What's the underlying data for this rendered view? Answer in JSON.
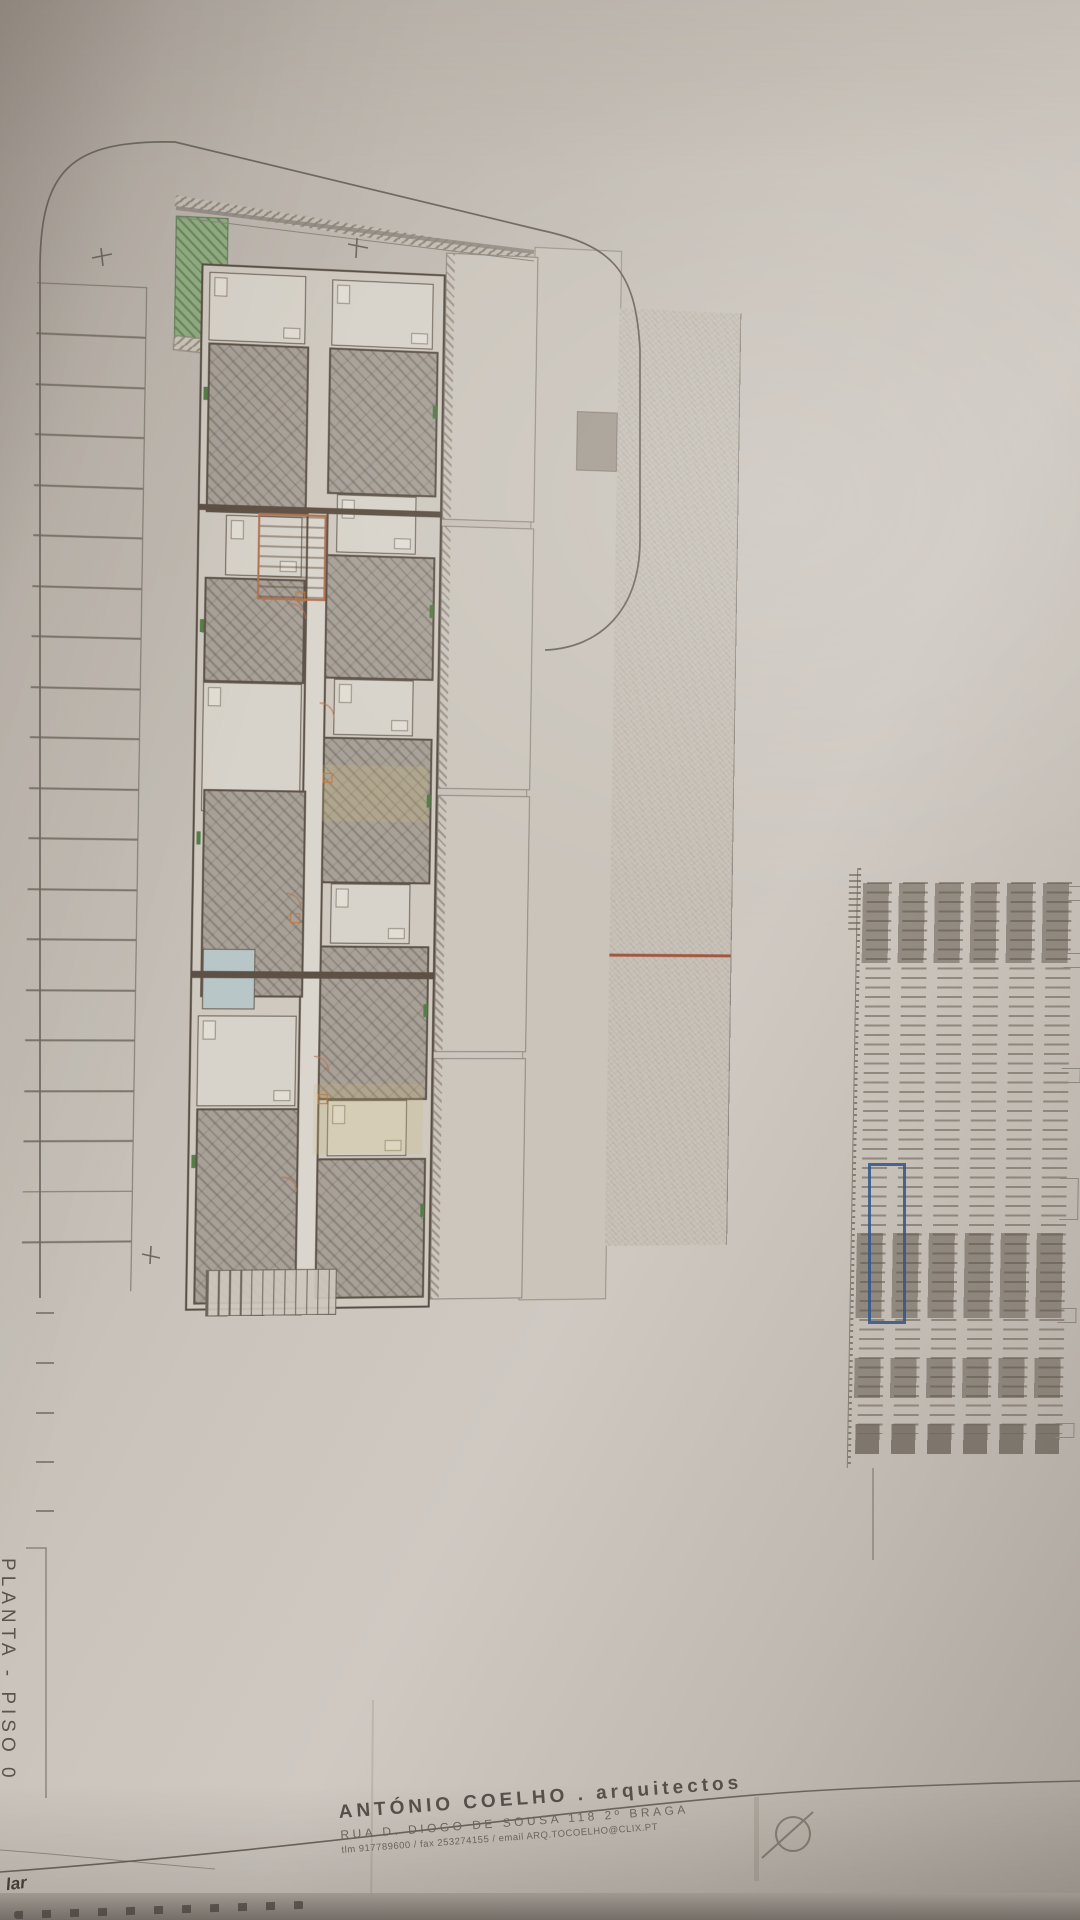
{
  "drawing": {
    "plan_label": "PLANTA - PISO 0",
    "title_block": {
      "firm_name": "ANTÓNIO COELHO . arquitectos",
      "firm_address": "RUA D. DIOGO DE SOUSA 118 2º BRAGA",
      "firm_contacts": "tlm 917789600 / fax 253274155 / email ARQ.TOCOELHO@CLIX.PT",
      "logo_icon": "circle-slash-logo"
    },
    "corner_note": "lar",
    "schedule_table": {
      "columns": 6,
      "legible": false
    },
    "colors": {
      "paper": "#cac4bb",
      "green_area": "#93ad83",
      "highlight_box": "#35568a",
      "red_marking": "#a05844",
      "wall": "#594f44",
      "pale_blue_room": "#b9c6c8"
    }
  }
}
